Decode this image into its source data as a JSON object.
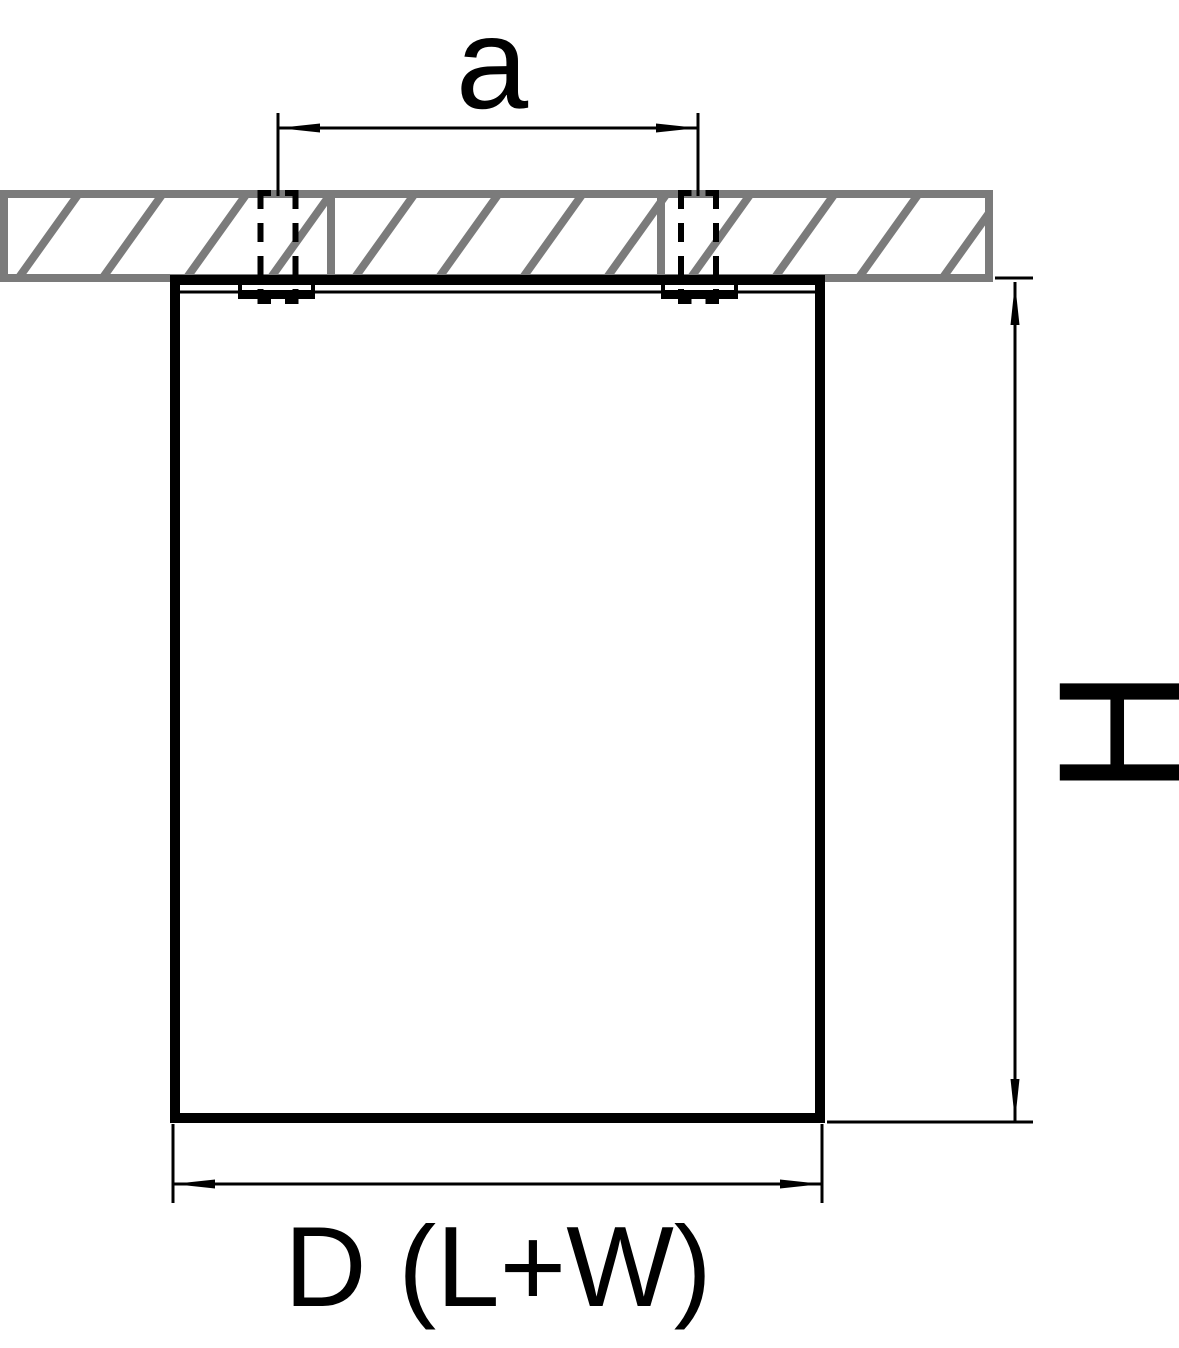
{
  "labels": {
    "dimension_a": "a",
    "dimension_h": "H",
    "dimension_d": "D (L+W)"
  },
  "colors": {
    "line": "#000000",
    "ceiling_gray": "#7b7b7b",
    "background": "#ffffff"
  }
}
